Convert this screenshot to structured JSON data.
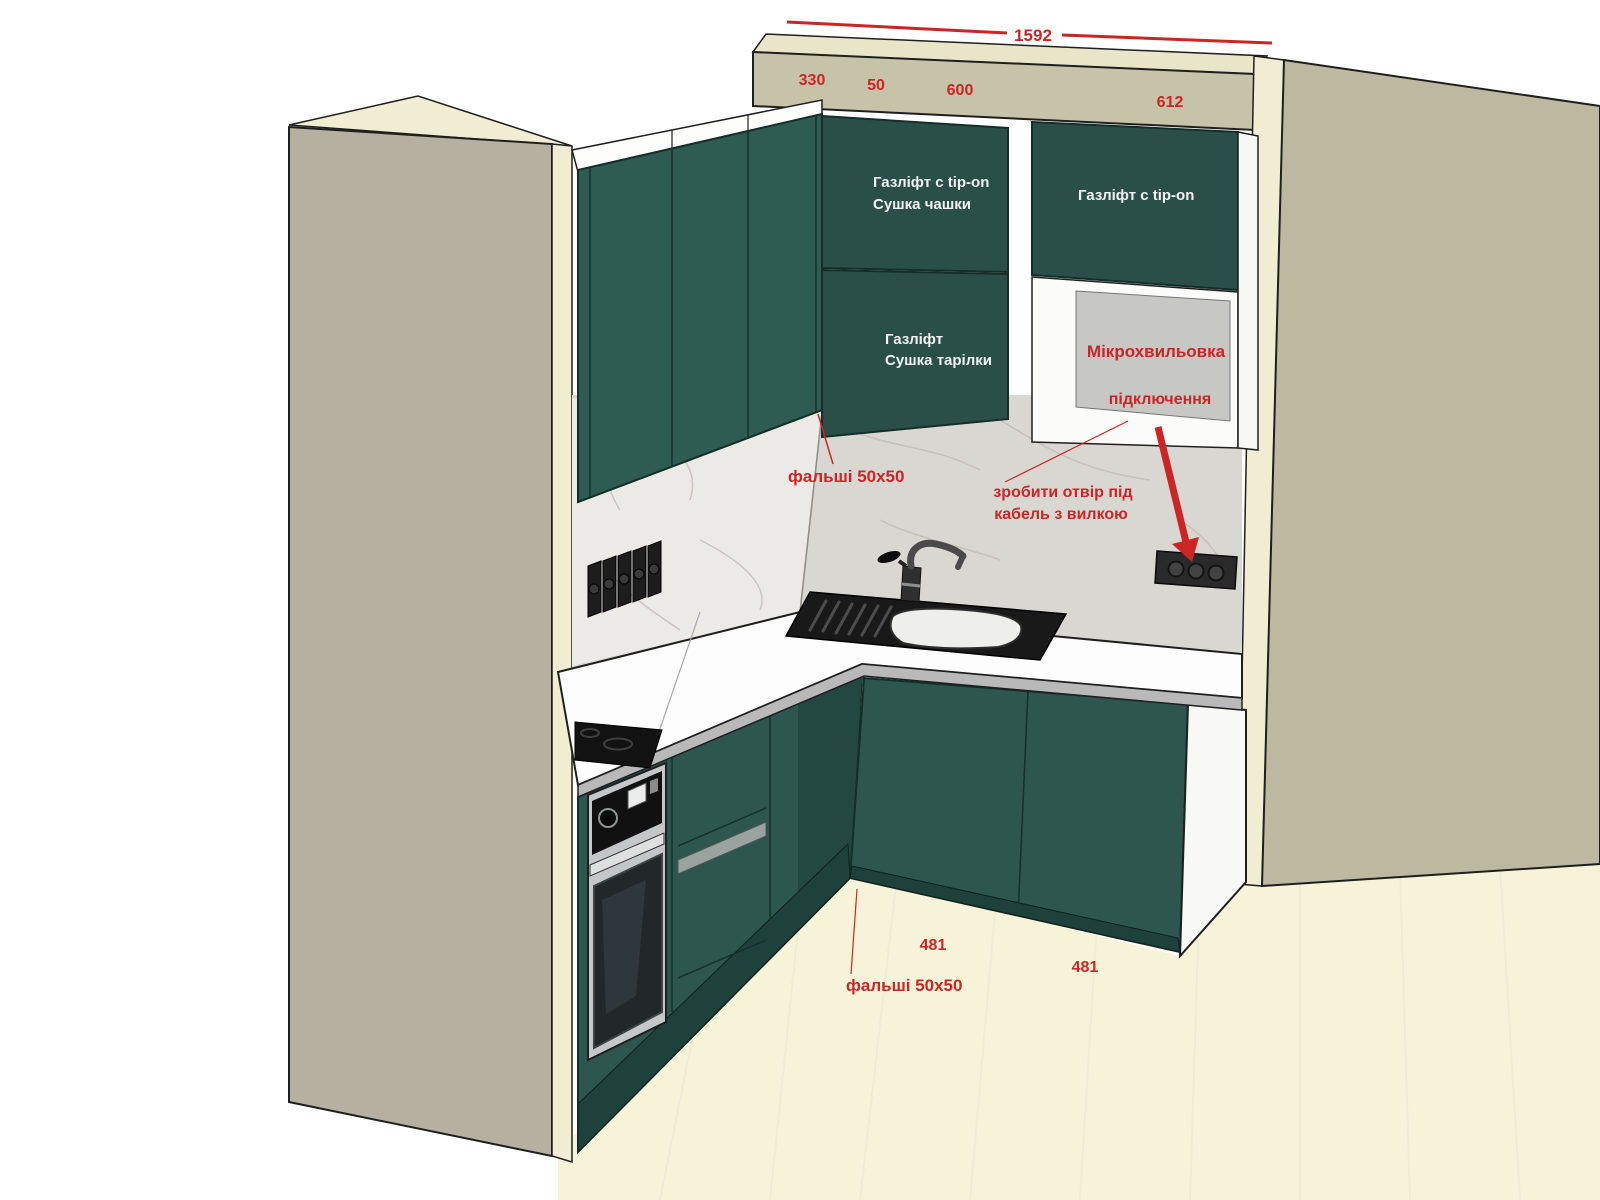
{
  "scene": {
    "title": "Kitchen corner 3D design render with dimension callouts",
    "colors": {
      "floor": "#f6f3d9",
      "wall_left": "#b5b0a0",
      "wall_right": "#bdb9a1",
      "bulkhead": "#c7c3a9",
      "bulkhead_top": "#e9e5c9",
      "edge_cream": "#f1edd2",
      "marble": "#d9d7d2",
      "marble_left": "#eceae6",
      "green_front": "#2a4f49",
      "green_side": "#2e5c53",
      "green_base": "#2c564e",
      "green_dark": "#234741",
      "plinth": "#1f413b",
      "countertop": "#fdfdfd",
      "counter_edge": "#b9b9b9",
      "steel": "#c3c7c7",
      "annotation_red": "#cb2525",
      "label_white": "#f2f2f2"
    }
  },
  "dimensions": {
    "total_width": "1592",
    "segment_330": "330",
    "segment_50": "50",
    "segment_600": "600",
    "segment_612": "612",
    "base_left_width": "481",
    "base_right_width": "481"
  },
  "cabinet_labels": {
    "upper_left_door_line1": "Газліфт с tip-on",
    "upper_left_door_line2": "Сушка чашки",
    "upper_right_door": "Газліфт с tip-on",
    "middle_left_door_line1": "Газліфт",
    "middle_left_door_line2": "Сушка тарілки"
  },
  "annotations": {
    "microwave_line1": "Мікрохвильовка",
    "microwave_line2": "підключення",
    "filler_note_top": "фальші 50x50",
    "filler_note_bottom": "фальші 50x50",
    "hole_note_line1": "зробити отвір під",
    "hole_note_line2": "кабель з вилкою"
  }
}
